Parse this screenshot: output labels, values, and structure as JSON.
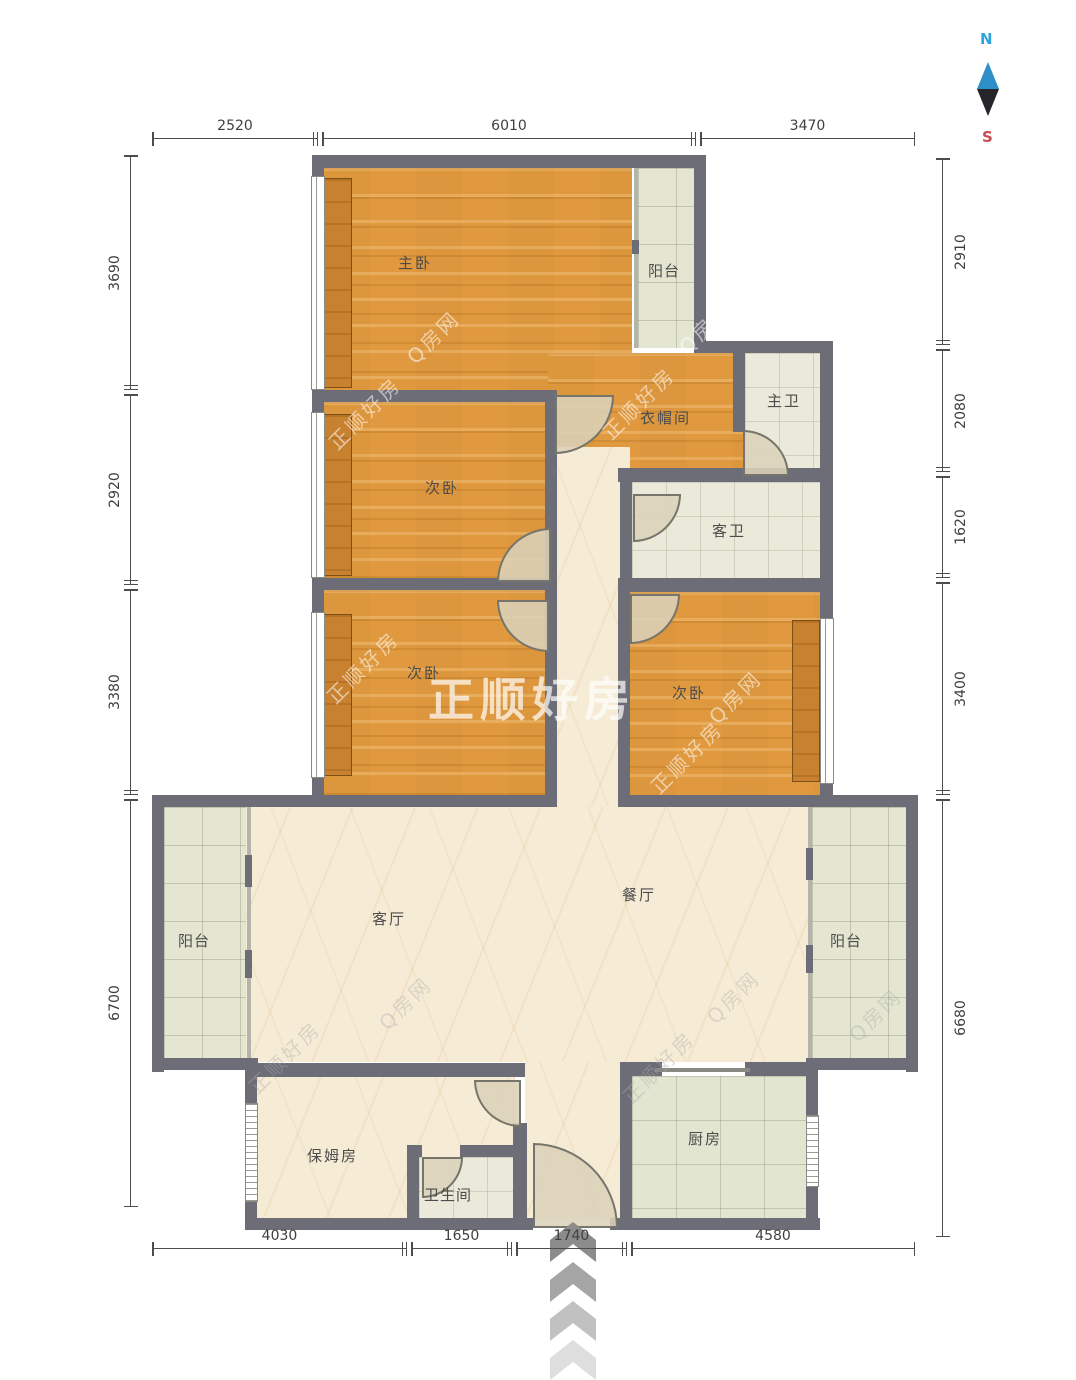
{
  "compass": {
    "north_label": "N",
    "south_label": "S",
    "north_color": "#2ea3dc",
    "south_color": "#c94a52",
    "needle_top_color": "#2f8fc9",
    "needle_bottom_color": "#26262a"
  },
  "watermarks": {
    "brand": "正顺好房",
    "site": "Q房网",
    "center": "正顺好房"
  },
  "rooms": {
    "master_bedroom": "主卧",
    "balcony_top": "阳台",
    "cloakroom": "衣帽间",
    "master_bath": "主卫",
    "guest_bath": "客卫",
    "bedroom_a": "次卧",
    "bedroom_b": "次卧",
    "bedroom_c": "次卧",
    "living_room": "客厅",
    "dining_room": "餐厅",
    "balcony_left": "阳台",
    "balcony_right": "阳台",
    "nanny_room": "保姆房",
    "bathroom": "卫生间",
    "kitchen": "厨房"
  },
  "dimensions": {
    "top": [
      "2520",
      "6010",
      "3470"
    ],
    "left": [
      "3690",
      "2920",
      "3380",
      "6700"
    ],
    "right": [
      "2910",
      "2080",
      "1620",
      "3400",
      "6680"
    ],
    "bottom": [
      "4030",
      "1650",
      "1740",
      "4580"
    ]
  }
}
